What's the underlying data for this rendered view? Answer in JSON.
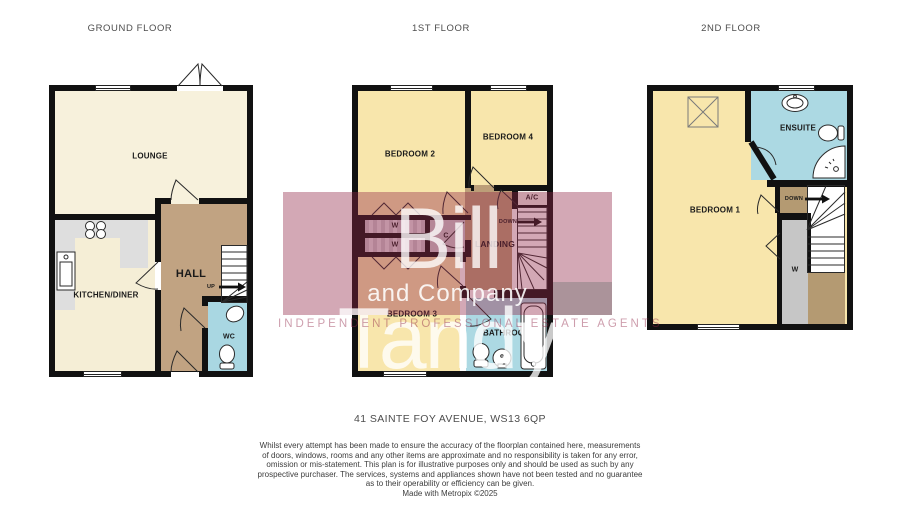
{
  "floors": {
    "ground": {
      "title": "GROUND FLOOR",
      "labels": {
        "lounge": "LOUNGE",
        "kitchen": "KITCHEN/DINER",
        "hall": "HALL",
        "up": "UP",
        "wc": "WC"
      }
    },
    "first": {
      "title": "1ST FLOOR",
      "labels": {
        "bedroom2": "BEDROOM 2",
        "bedroom4": "BEDROOM 4",
        "ac": "A/C",
        "down": "DOWN",
        "landing": "LANDING",
        "w_top": "W",
        "w_bottom": "W",
        "cupboard": "C",
        "bedroom3": "BEDROOM 3",
        "bathroom": "BATHROOM"
      }
    },
    "second": {
      "title": "2ND FLOOR",
      "labels": {
        "bedroom1": "BEDROOM 1",
        "ensuite": "ENSUITE",
        "down": "DOWN",
        "wardrobe": "W"
      }
    }
  },
  "watermark": {
    "name": "Bill Tandy",
    "subtitle": "and Company",
    "tagline": "INDEPENDENT PROFESSIONAL ESTATE AGENTS",
    "brand_color": "#912646"
  },
  "footer": {
    "address": "41 SAINTE FOY AVENUE, WS13 6QP",
    "disclaimer": [
      "Whilst every attempt has been made to ensure the accuracy of the floorplan contained here, measurements",
      "of doors, windows, rooms and any other items are approximate and no responsibility is taken for any error,",
      "omission or mis-statement. This plan is for illustrative purposes only and should be used as such by any",
      "prospective purchaser. The services, systems and appliances shown have not been tested and no guarantee",
      "as to their operability or efficiency can be given.",
      "Made with Metropix ©2025"
    ]
  },
  "colors": {
    "wall": "#111111",
    "lounge": "#F7F1DC",
    "kitchen": "#F5EED6",
    "hall_brown": "#C1A382",
    "wc_blue": "#A9D7E2",
    "bedroom_yellow": "#F8E6AC",
    "landing_brown": "#BC9E78",
    "bathroom_blue": "#ACD9E3",
    "closet_gray": "#CBC3CB",
    "wardrobe_gray": "#C6C6C6",
    "counter_gray": "#DEDEDE",
    "watermark_claret": "#912646"
  }
}
